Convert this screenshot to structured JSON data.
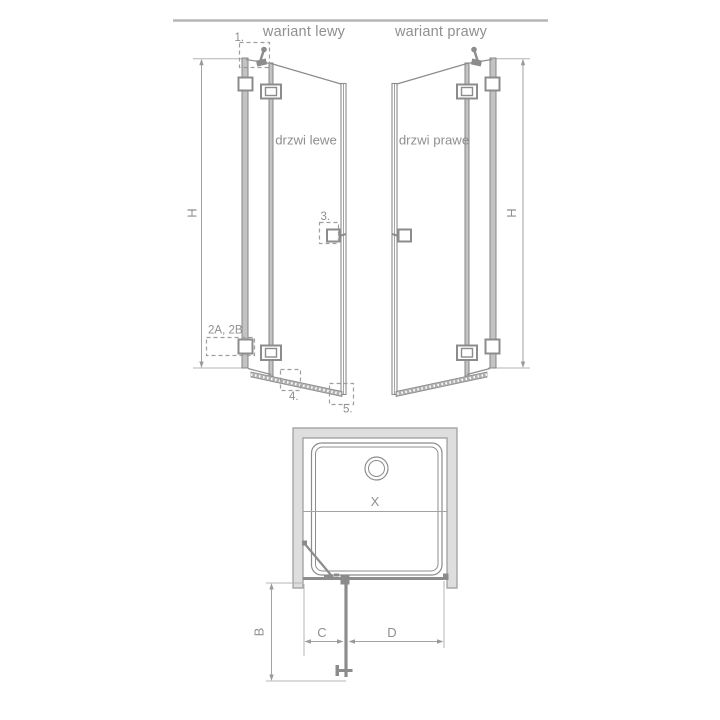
{
  "colors": {
    "background": "#ffffff",
    "divider": "#b6b6b6",
    "stroke": "#8c8c8c",
    "dimension": "#a2a2a2",
    "wall_fill": "#dedede",
    "profile_fill": "#c3c3c3",
    "text": "#8f8f8f"
  },
  "headers": {
    "left": "wariant lewy",
    "right": "wariant prawy"
  },
  "front": {
    "left": {
      "label": "drzwi lewe",
      "dim": "H",
      "callout_1": "1.",
      "callout_2": "2A, 2B",
      "callout_3": "3.",
      "callout_4": "4.",
      "callout_5": "5."
    },
    "right": {
      "label": "drzwi prawe",
      "dim": "H"
    }
  },
  "plan": {
    "dim_x": "X",
    "dim_b": "B",
    "dim_c": "C",
    "dim_d": "D"
  }
}
